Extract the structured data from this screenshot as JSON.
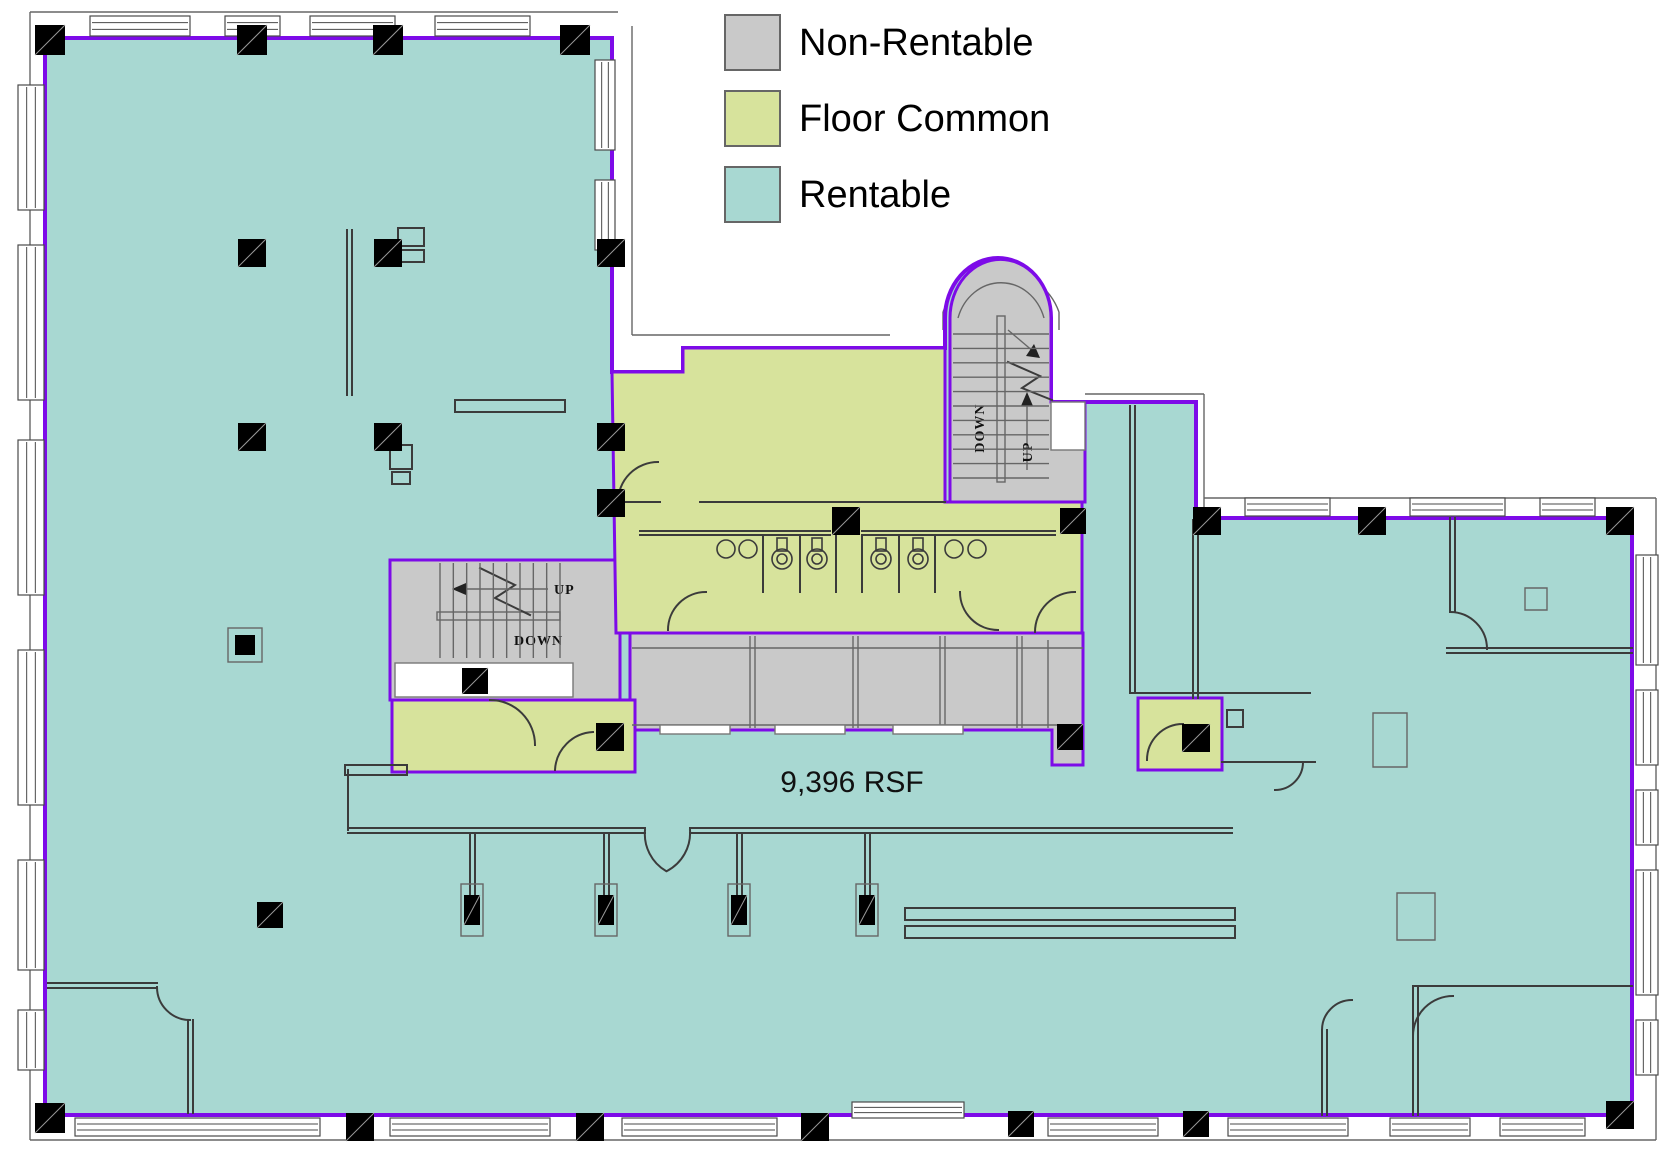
{
  "legend": {
    "items": [
      {
        "id": "non-rentable",
        "label": "Non-Rentable",
        "color": "#c9c9c9"
      },
      {
        "id": "floor-common",
        "label": "Floor Common",
        "color": "#d7e39c"
      },
      {
        "id": "rentable",
        "label": "Rentable",
        "color": "#a8d8d2"
      }
    ]
  },
  "area_label": {
    "text": "9,396  RSF"
  },
  "stair_labels": {
    "up": "UP",
    "down": "DOWN"
  },
  "colors": {
    "rentable": "#a8d8d2",
    "common": "#d7e39c",
    "nonrentable": "#c9c9c9",
    "boundary": "#7d0be8",
    "wall": "#3b3b3b"
  },
  "floorplan": {
    "viewbox": "0 0 1672 1171",
    "shapes": [
      {
        "tag": "path",
        "name": "exterior-trim",
        "class": "st-thin",
        "attrs": {
          "d": "M30,12 H618 M30,12 V1140 M30,1140 H1656 M1656,1140 V498 M1656,498 H1204 M632,26 V335 M632,335 H890 M1085,394 H1204 M1204,394 V512 M943,312 A62,64 0 0 1 1059,312 M943,312 V330 M1059,312 V330"
        }
      },
      {
        "tag": "path",
        "name": "rentable-area",
        "class": "rentable pb",
        "attrs": {
          "d": "M45,38 H612 V372 H683 V348 H945 V318 A53,60 0 0 1 1051,318 V402 H1196 V518 H1632 V1115 H45 Z"
        }
      },
      {
        "tag": "path",
        "name": "stair-block-west",
        "class": "nonrent pb pb3",
        "attrs": {
          "d": "M390,560 H620 V700 H390 Z"
        }
      },
      {
        "tag": "path",
        "name": "stair-block-north",
        "class": "nonrent pb pb3",
        "attrs": {
          "d": "M950,318 A50,58 0 0 1 1051,318 V402 H1085 V502 H950 Z"
        }
      },
      {
        "tag": "rect",
        "name": "wall-notch",
        "class": "notch",
        "attrs": {
          "x": 1051,
          "y": 402,
          "width": 34,
          "height": 48
        }
      },
      {
        "tag": "path",
        "name": "corridor",
        "class": "nonrent pb pb3",
        "attrs": {
          "d": "M630,633 H1083 V765 H1052 V730 H630 Z"
        }
      },
      {
        "tag": "path",
        "name": "floor-common-center",
        "class": "common pb pb3",
        "attrs": {
          "d": "M612,372 H683 V348 H945 V502 H1082 V633 H616 Z"
        }
      },
      {
        "tag": "path",
        "name": "floor-common-west-room",
        "class": "common pb pb3",
        "attrs": {
          "d": "M392,700 H635 V772 H392 Z"
        }
      },
      {
        "tag": "path",
        "name": "floor-common-east-room",
        "class": "common pb pb3",
        "attrs": {
          "d": "M1138,698 H1222 V770 H1138 Z"
        }
      },
      {
        "tag": "path",
        "name": "interior-walls-west",
        "class": "st-wall",
        "attrs": {
          "d": "M347,230 V395 M352,230 V395 M398,228 h26 v18 h-26 Z M398,250 h26 v12 h-26 Z M455,400 H565 V412 H455 Z M390,445 h22 v24 h-22 Z M392,472 h18 v12 h-18 Z M345,765 h62 v10 h-62 Z M48,983 H157 M48,988 H157 M188,1020 V1113 M193,1020 V1113"
        }
      },
      {
        "tag": "path",
        "name": "lobby-walls",
        "class": "st-wall",
        "attrs": {
          "d": "M348,770 V830 M348,828 H645 M348,833 H645 M690,828 H1232 M690,833 H1232 M470,833 V895 M475,833 V895 M604,833 V895 M609,833 V895 M737,833 V895 M742,833 V895 M865,833 V895 M870,833 V895 M905,908 h330 v12 h-330 Z M905,926 h330 v12 h-330 Z"
        }
      },
      {
        "tag": "path",
        "name": "bathroom-walls",
        "class": "st-wall",
        "attrs": {
          "d": "M640,531 H830 M640,535 H830 M862,531 H1055 M862,535 H1055 M763,535 V592 M800,535 V592 M836,535 V592 M862,535 V592 M899,535 V592 M935,535 V592 M616,502 H660 M700,502 H945"
        }
      },
      {
        "tag": "path",
        "name": "corridor-cell-walls",
        "class": "st-thin",
        "attrs": {
          "d": "M632,648 H1083 M632,725 H1083 M750,636 V728 M755,636 V728 M853,636 V728 M858,636 V728 M940,636 V728 M945,636 V728 M1017,636 V728 M1022,636 V728 M1048,640 V728"
        }
      },
      {
        "tag": "rect",
        "name": "corridor-window-1",
        "class": "notch",
        "attrs": {
          "x": 660,
          "y": 725,
          "width": 70,
          "height": 9
        }
      },
      {
        "tag": "rect",
        "name": "corridor-window-2",
        "class": "notch",
        "attrs": {
          "x": 775,
          "y": 725,
          "width": 70,
          "height": 9
        }
      },
      {
        "tag": "rect",
        "name": "corridor-window-3",
        "class": "notch",
        "attrs": {
          "x": 893,
          "y": 725,
          "width": 70,
          "height": 9
        }
      },
      {
        "tag": "path",
        "name": "strip-walls",
        "class": "st-wall",
        "attrs": {
          "d": "M1130,406 V693 M1135,406 V693 M1130,693 H1310 M1222,762 H1315 M1193,520 V698 M1198,520 V698 M1227,710 h16 v17 h-16 Z"
        }
      },
      {
        "tag": "path",
        "name": "east-room-walls",
        "class": "st-wall",
        "attrs": {
          "d": "M1450,518 V612 M1455,518 V612 M1447,648 H1632 M1447,653 H1632 M1413,988 V1115 M1418,988 V1115 M1413,986 H1632 M1322,1030 V1115 M1327,1030 V1115"
        }
      },
      {
        "tag": "path",
        "name": "furniture",
        "class": "st-thin",
        "attrs": {
          "d": "M1373,713 h34 v54 h-34 Z M1397,893 h38 v47 h-38 Z M1525,588 h22 v22 h-22 Z"
        }
      },
      {
        "tag": "path",
        "name": "door-arcs",
        "class": "st-wall",
        "attrs": {
          "d": "M618,502 A40,40 0 0 1 658,462 M668,630 A38,38 0 0 1 706,592 M960,592 A38,38 0 0 0 998,630 M1035,632 A40,40 0 0 1 1075,592 M645,830 A43,43 0 0 0 666,871 M690,830 A43,43 0 0 1 667,871 M490,700 A45,45 0 0 1 535,745 M555,770 A40,40 0 0 1 593,732 M1147,760 A36,36 0 0 1 1183,724 M1450,612 A37,37 0 0 1 1487,649 M1413,1036 A40,40 0 0 1 1453,996 M1322,1030 A30,30 0 0 1 1352,1000 M157,987 A33,33 0 0 0 190,1020 M1275,790 A28,28 0 0 0 1303,762"
        }
      },
      {
        "tag": "rect",
        "name": "stair-west-landing",
        "class": "notch",
        "attrs": {
          "x": 395,
          "y": 663,
          "width": 178,
          "height": 34
        }
      },
      {
        "tag": "rect",
        "name": "stair-west-mid-rail",
        "class": "st-thin",
        "attrs": {
          "x": 437,
          "y": 612,
          "width": 123,
          "height": 8,
          "fill": "#fff"
        }
      },
      {
        "tag": "polyline",
        "name": "stair-west-break-line",
        "class": "st-wall",
        "attrs": {
          "points": "480,568 515,585 495,598 530,615",
          "fill": "none"
        }
      },
      {
        "tag": "line",
        "name": "stair-west-arrow-line",
        "class": "st-thin",
        "attrs": {
          "x1": 466,
          "y1": 589,
          "x2": 548,
          "y2": 589
        }
      },
      {
        "tag": "polygon",
        "name": "stair-west-arrowhead",
        "class": "arrow",
        "attrs": {
          "points": "452,589 466,583 466,595"
        }
      },
      {
        "tag": "text",
        "name": "stair-west-up-label",
        "class": "stairtxt",
        "bind": "stair_labels.up",
        "attrs": {
          "x": 554,
          "y": 594
        }
      },
      {
        "tag": "text",
        "name": "stair-west-down-label",
        "class": "stairtxt",
        "bind": "stair_labels.down",
        "attrs": {
          "x": 514,
          "y": 645
        }
      },
      {
        "tag": "rect",
        "name": "stair-north-rail",
        "class": "st-thin",
        "attrs": {
          "x": 997,
          "y": 316,
          "width": 8,
          "height": 166,
          "fill": "#fff"
        }
      },
      {
        "tag": "path",
        "name": "stair-north-inner-arch",
        "class": "st-thin",
        "attrs": {
          "d": "M958,318 A45,50 0 0 1 1044,318"
        }
      },
      {
        "tag": "polyline",
        "name": "stair-north-break-line",
        "class": "st-wall",
        "attrs": {
          "points": "1008,362 1040,376 1022,388 1052,400",
          "fill": "none"
        }
      },
      {
        "tag": "line",
        "name": "stair-north-up-arrow-line",
        "class": "st-thin",
        "attrs": {
          "x1": 1027,
          "y1": 404,
          "x2": 1027,
          "y2": 470
        }
      },
      {
        "tag": "polygon",
        "name": "stair-north-up-arrowhead",
        "class": "arrow",
        "attrs": {
          "points": "1027,392 1021,406 1033,406"
        }
      },
      {
        "tag": "line",
        "name": "stair-north-down-arrow-line",
        "class": "st-thin",
        "attrs": {
          "x1": 1008,
          "y1": 330,
          "x2": 1034,
          "y2": 352
        }
      },
      {
        "tag": "polygon",
        "name": "stair-north-down-arrowhead",
        "class": "arrow",
        "attrs": {
          "points": "1040,358 1026,356 1034,344"
        }
      },
      {
        "tag": "text",
        "name": "stair-north-down-label",
        "class": "stairtxt",
        "bind": "stair_labels.down",
        "attrs": {
          "x": 984,
          "y": 428,
          "transform": "rotate(-90 984 428)",
          "text-anchor": "middle"
        }
      },
      {
        "tag": "text",
        "name": "stair-north-up-label",
        "class": "stairtxt",
        "bind": "stair_labels.up",
        "attrs": {
          "x": 1032,
          "y": 452,
          "transform": "rotate(-90 1032 452)",
          "text-anchor": "middle"
        }
      },
      {
        "tag": "text",
        "name": "rsf-label",
        "class": "rsf",
        "bind": "area_label.text",
        "attrs": {
          "x": 852,
          "y": 792,
          "text-anchor": "middle"
        }
      }
    ],
    "stairs": [
      {
        "name": "stair-west-treads",
        "dir": "v",
        "from": 440,
        "to": 560,
        "n": 10,
        "a": 563,
        "b": 658
      },
      {
        "name": "stair-north-treads",
        "dir": "h",
        "from": 334,
        "to": 478,
        "n": 11,
        "a": 953,
        "b": 1049
      }
    ],
    "fixtures": {
      "sinks": [
        [
          726,
          549
        ],
        [
          748,
          549
        ],
        [
          954,
          549
        ],
        [
          977,
          549
        ]
      ],
      "toilets": [
        [
          782,
          559
        ],
        [
          817,
          559
        ],
        [
          881,
          559
        ],
        [
          918,
          559
        ]
      ]
    },
    "columns": [
      {
        "x": 50,
        "y": 40,
        "s": 30
      },
      {
        "x": 252,
        "y": 40,
        "s": 30
      },
      {
        "x": 388,
        "y": 40,
        "s": 30
      },
      {
        "x": 575,
        "y": 40,
        "s": 30
      },
      {
        "x": 252,
        "y": 253,
        "s": 28
      },
      {
        "x": 388,
        "y": 253,
        "s": 28
      },
      {
        "x": 611,
        "y": 253,
        "s": 28
      },
      {
        "x": 252,
        "y": 437,
        "s": 28
      },
      {
        "x": 388,
        "y": 437,
        "s": 28
      },
      {
        "x": 611,
        "y": 437,
        "s": 28
      },
      {
        "x": 611,
        "y": 503,
        "s": 28
      },
      {
        "x": 475,
        "y": 681,
        "s": 26
      },
      {
        "x": 610,
        "y": 737,
        "s": 28
      },
      {
        "x": 846,
        "y": 521,
        "s": 28
      },
      {
        "x": 1073,
        "y": 521,
        "s": 26
      },
      {
        "x": 1070,
        "y": 737,
        "s": 26
      },
      {
        "x": 1207,
        "y": 521,
        "s": 28
      },
      {
        "x": 1196,
        "y": 738,
        "s": 28
      },
      {
        "x": 1372,
        "y": 521,
        "s": 28
      },
      {
        "x": 1620,
        "y": 521,
        "s": 28
      },
      {
        "x": 270,
        "y": 915,
        "s": 26
      },
      {
        "x": 472,
        "y": 910,
        "t": "tall"
      },
      {
        "x": 606,
        "y": 910,
        "t": "tall"
      },
      {
        "x": 739,
        "y": 910,
        "t": "tall"
      },
      {
        "x": 867,
        "y": 910,
        "t": "tall"
      },
      {
        "x": 245,
        "y": 645,
        "t": "boxed"
      },
      {
        "x": 360,
        "y": 1127,
        "s": 28
      },
      {
        "x": 590,
        "y": 1127,
        "s": 28
      },
      {
        "x": 815,
        "y": 1127,
        "s": 28
      },
      {
        "x": 1021,
        "y": 1124,
        "s": 26
      },
      {
        "x": 1196,
        "y": 1124,
        "s": 26
      },
      {
        "x": 1620,
        "y": 1115,
        "s": 28
      },
      {
        "x": 50,
        "y": 1118,
        "s": 30
      }
    ],
    "windows": [
      {
        "x": 90,
        "y": 16,
        "w": 100,
        "h": 20
      },
      {
        "x": 225,
        "y": 16,
        "w": 55,
        "h": 20
      },
      {
        "x": 310,
        "y": 16,
        "w": 85,
        "h": 20
      },
      {
        "x": 435,
        "y": 16,
        "w": 95,
        "h": 20
      },
      {
        "x": 18,
        "y": 85,
        "w": 26,
        "h": 125
      },
      {
        "x": 18,
        "y": 245,
        "w": 26,
        "h": 155
      },
      {
        "x": 18,
        "y": 440,
        "w": 26,
        "h": 155
      },
      {
        "x": 18,
        "y": 650,
        "w": 26,
        "h": 155
      },
      {
        "x": 18,
        "y": 860,
        "w": 26,
        "h": 110
      },
      {
        "x": 18,
        "y": 1010,
        "w": 26,
        "h": 60
      },
      {
        "x": 75,
        "y": 1118,
        "w": 245,
        "h": 18
      },
      {
        "x": 390,
        "y": 1118,
        "w": 160,
        "h": 18
      },
      {
        "x": 622,
        "y": 1118,
        "w": 155,
        "h": 18
      },
      {
        "x": 852,
        "y": 1102,
        "w": 112,
        "h": 16
      },
      {
        "x": 1048,
        "y": 1118,
        "w": 110,
        "h": 18
      },
      {
        "x": 1228,
        "y": 1118,
        "w": 120,
        "h": 18
      },
      {
        "x": 1390,
        "y": 1118,
        "w": 80,
        "h": 18
      },
      {
        "x": 1500,
        "y": 1118,
        "w": 85,
        "h": 18
      },
      {
        "x": 1636,
        "y": 555,
        "w": 22,
        "h": 110
      },
      {
        "x": 1636,
        "y": 690,
        "w": 22,
        "h": 75
      },
      {
        "x": 1636,
        "y": 790,
        "w": 22,
        "h": 55
      },
      {
        "x": 1636,
        "y": 870,
        "w": 22,
        "h": 125
      },
      {
        "x": 1636,
        "y": 1020,
        "w": 22,
        "h": 55
      },
      {
        "x": 1245,
        "y": 498,
        "w": 85,
        "h": 18
      },
      {
        "x": 1410,
        "y": 498,
        "w": 95,
        "h": 18
      },
      {
        "x": 1540,
        "y": 498,
        "w": 55,
        "h": 18
      },
      {
        "x": 595,
        "y": 60,
        "w": 20,
        "h": 90
      },
      {
        "x": 595,
        "y": 180,
        "w": 20,
        "h": 70
      }
    ]
  }
}
